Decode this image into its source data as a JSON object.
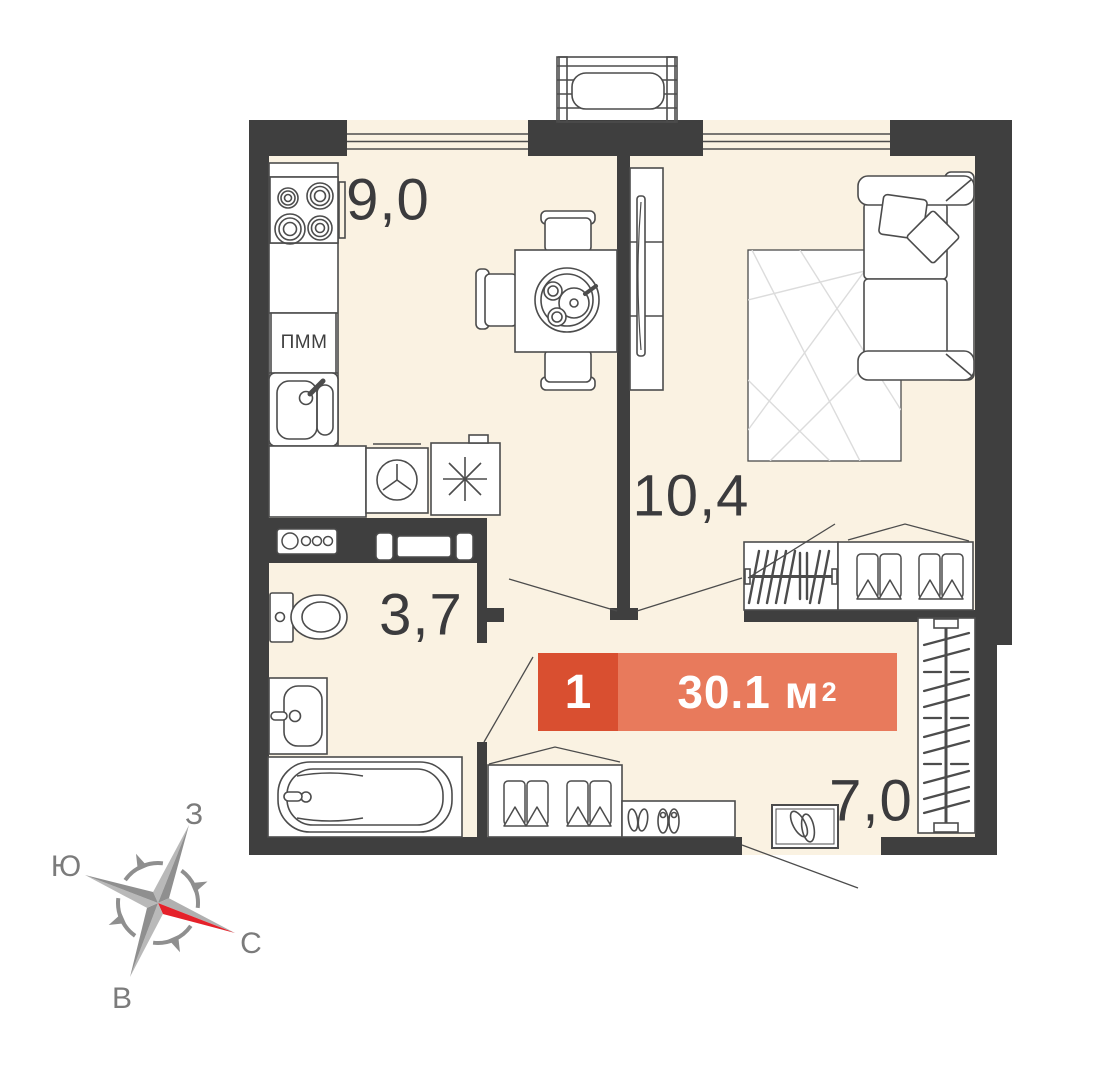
{
  "badge": {
    "rooms": "1",
    "area": "30.1 м",
    "area_exponent": "2"
  },
  "areas": {
    "kitchen": "9,0",
    "living_room": "10,4",
    "bathroom": "3,7",
    "hallway": "7,0"
  },
  "appliances": {
    "dishwasher": "ПММ"
  },
  "compass": {
    "west": "З",
    "south": "Ю",
    "north": "С",
    "east": "В"
  },
  "colors": {
    "floor": "#FAF2E2",
    "walls": "#3F3F3F",
    "badge_rooms_bg": "#D94F30",
    "badge_area_bg": "#E87A5C",
    "compass_red": "#E5212A",
    "outline": "#4C4C4C"
  }
}
